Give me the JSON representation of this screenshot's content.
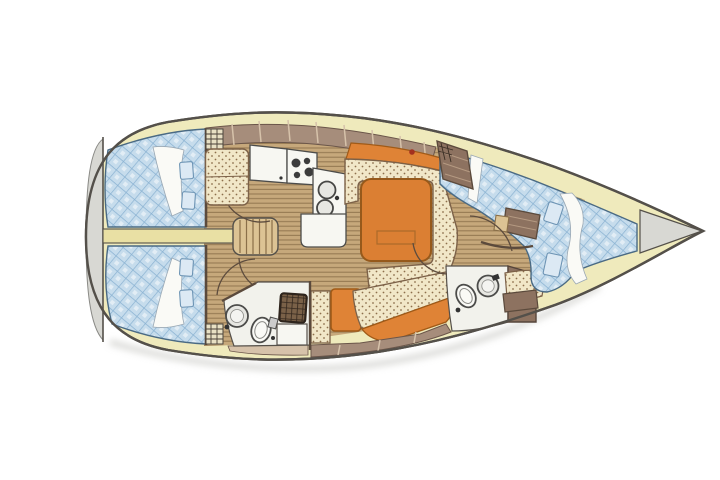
{
  "diagram": {
    "kind": "sailboat-interior-floor-plan",
    "orientation": {
      "bow": "right",
      "stern": "left"
    },
    "areas": [
      "stern-swim-platform",
      "aft-cabin-port-double-berth",
      "aft-cabin-starboard-double-berth",
      "companionway-steps",
      "galley-with-stove-and-double-sink",
      "salon-u-settee-with-table",
      "starboard-settee",
      "aft-head-with-toilet-basin-shower",
      "forward-head-with-toilet-basin",
      "hanging-locker",
      "forward-cabin-double-berth",
      "bow-anchor-locker"
    ],
    "icons": [
      "deck-hatch-icon",
      "stove-burners-icon",
      "double-sink-icon",
      "toilet-icon",
      "washbasin-icon",
      "shower-grate-icon",
      "hanging-locker-icon",
      "door-swing-arc-icon"
    ]
  },
  "colors": {
    "hull_outline": "#54504a",
    "deck_cream": "#efeabc",
    "platform_gray": "#d8d8d3",
    "shadow_gray": "#c2c2bd",
    "berth_blue": "#c6dcec",
    "berth_blue_line": "#8ab2d2",
    "berth_pillow": "#dce9f4",
    "sheet_white": "#fafaf6",
    "wood_floor": "#c6a87b",
    "wood_stripe": "#977b53",
    "locker_band": "#a68d7b",
    "band_divider": "#d6c2aa",
    "wall_brown": "#5b4a3c",
    "cabinet_brown": "#8d7260",
    "cabinet_line": "#b59a82",
    "cushion_cream": "#f1e7c8",
    "cushion_dot": "#8d6f4c",
    "cushion_edge": "#7c6148",
    "upholstery_orange": "#df8336",
    "orange_edge": "#a05a17",
    "table_orange": "#db7f33",
    "counter_white": "#f7f7f2",
    "fixture_gray": "#e7e7e2",
    "fixture_stroke": "#4c4c4a",
    "burner_dark": "#3c3c3c",
    "grate_brown": "#7a6148",
    "grate_line": "#33271d",
    "step_tan": "#dcc394",
    "step_line": "#8a6f49",
    "passage_cream": "#e9e0a4",
    "accent_red": "#a3301f",
    "head_floor": "#f2f2ec",
    "hatch_cream": "#e8e0c4"
  }
}
